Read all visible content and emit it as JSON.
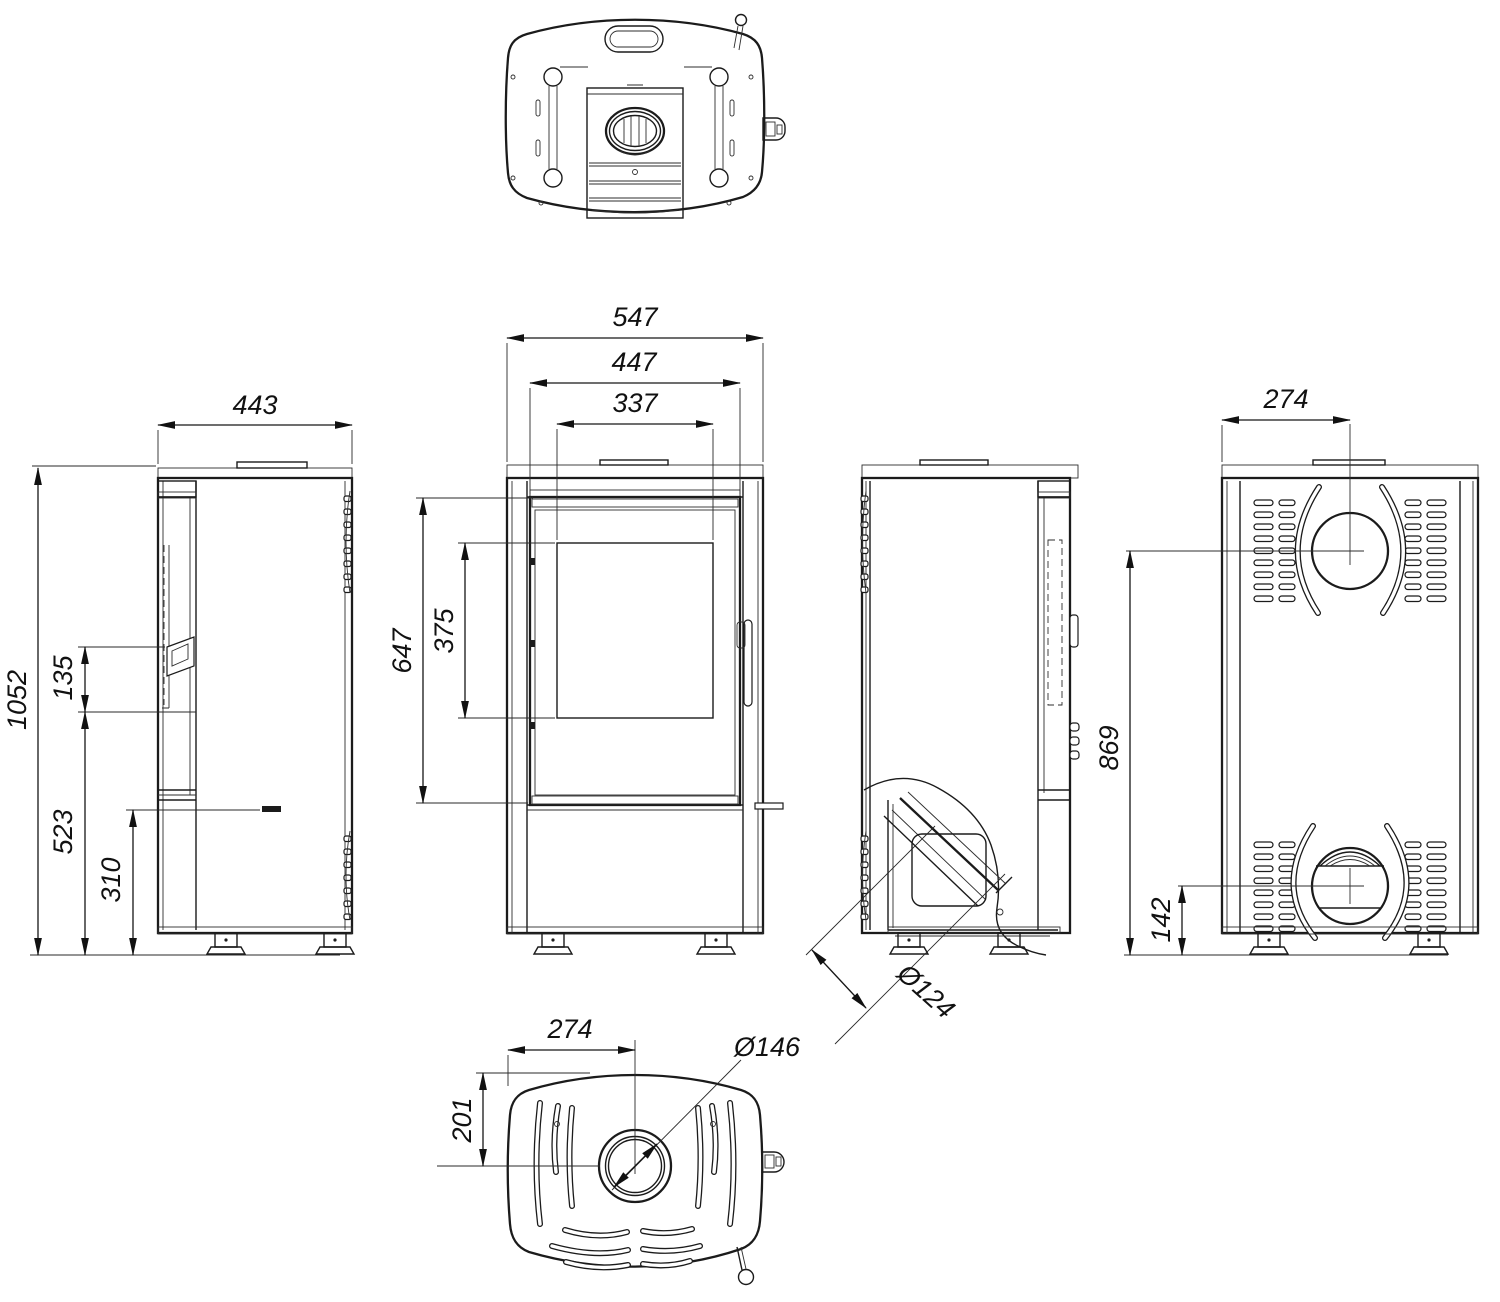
{
  "drawing": {
    "type": "technical-dimension-drawing",
    "subject": "free-standing wood stove, five orthographic views",
    "units": "mm",
    "line_color": "#1b1b1b",
    "background": "#ffffff"
  },
  "dims": {
    "side_width": "443",
    "total_height": "1052",
    "handle_span": "135",
    "base_height": "523",
    "lever_height": "310",
    "front_width": "547",
    "door_width": "447",
    "glass_width": "337",
    "door_height": "647",
    "glass_height": "375",
    "air_inlet_dia": "Ø124",
    "rear_flue_offset": "274",
    "rear_flue_height": "869",
    "rear_inlet_height": "142",
    "bottom_offset": "274",
    "bottom_depth": "201",
    "bottom_opening_dia": "Ø146"
  }
}
